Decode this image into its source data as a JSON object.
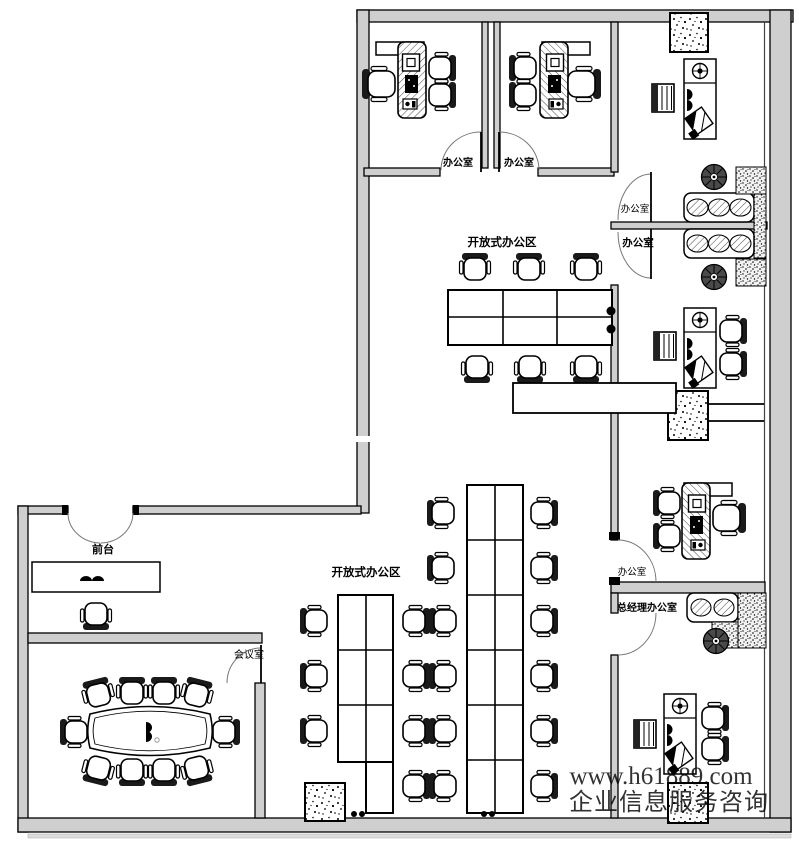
{
  "floorplan": {
    "labels": {
      "office_top_1": "办公室",
      "office_top_2": "办公室",
      "open_area_upper": "开放式办公区",
      "office_right_top": "办公室",
      "office_right_mid": "办公室",
      "office_right_lower": "办公室",
      "gm_office": "总经理办公室",
      "reception": "前台",
      "meeting_room": "会议室",
      "open_area_lower": "开放式办公区"
    },
    "watermark": {
      "url": "www.h61889.com",
      "caption": "企业信息服务咨询",
      "color": "#cd6969"
    }
  }
}
